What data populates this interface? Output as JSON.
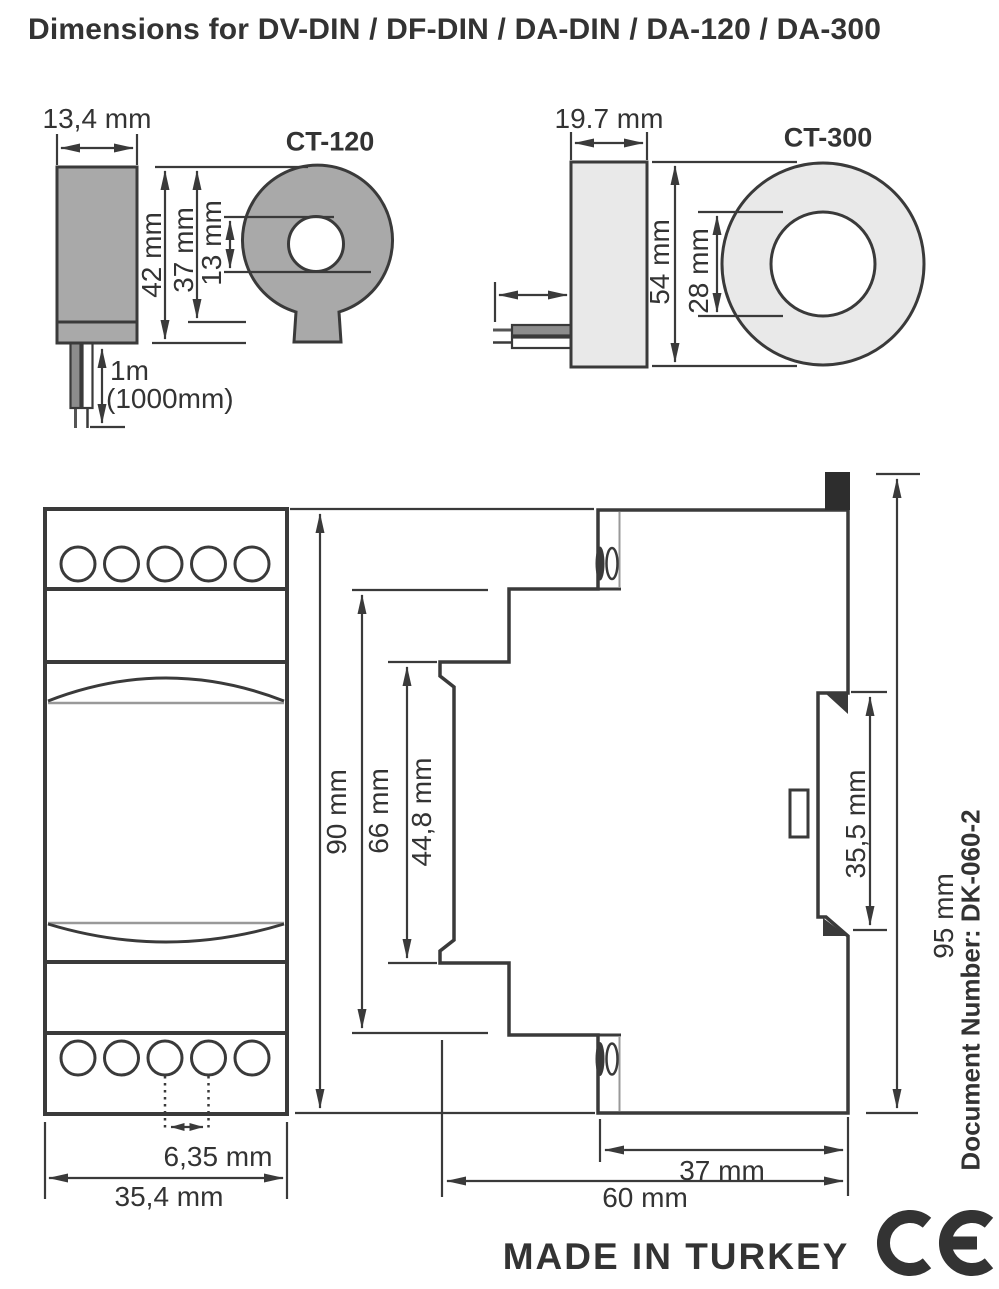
{
  "title": "Dimensions for DV-DIN / DF-DIN / DA-DIN / DA-120 / DA-300",
  "ct120": {
    "label": "CT-120",
    "body_width": "13,4 mm",
    "total_height": "42 mm",
    "ring_outer_diameter": "37 mm",
    "hole_diameter": "13 mm",
    "cable_length": "1m",
    "cable_length_mm": "(1000mm)"
  },
  "ct300": {
    "label": "CT-300",
    "body_width": "19.7 mm",
    "ring_outer_diameter": "54 mm",
    "hole_diameter": "28 mm"
  },
  "module": {
    "front_height": "90 mm",
    "front_width": "35,4 mm",
    "terminal_pitch": "6,35 mm",
    "body_height": "66 mm",
    "front_section_height": "44,8 mm",
    "rail_recess_height": "35,5 mm",
    "total_height": "95 mm",
    "rear_depth": "37 mm",
    "total_depth": "60 mm"
  },
  "footer": {
    "made_in": "MADE IN TURKEY",
    "document_number": "Document Number: DK-060-2",
    "ce_mark": "CE"
  },
  "colors": {
    "line": "#3a3a3a",
    "ct120_fill": "#a9a9a9",
    "ct300_fill": "#e9e9e9",
    "wire_gray": "#8c8c8c",
    "clip_black": "#2d2d2d"
  }
}
